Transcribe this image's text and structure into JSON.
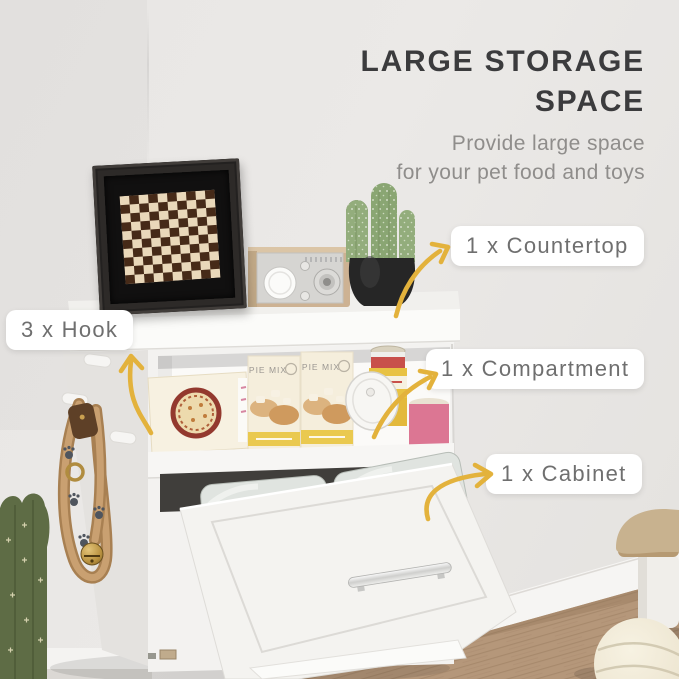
{
  "header": {
    "title": "LARGE STORAGE SPACE",
    "subtitle_line1": "Provide large space",
    "subtitle_line2": "for your pet food and toys"
  },
  "callouts": {
    "hook": "3 x Hook",
    "countertop": "1 x Countertop",
    "compartment": "1 x Compartment",
    "cabinet": "1 x Cabinet"
  },
  "scene": {
    "pie_box_label": "PIE MIX",
    "bag_script_word": "love",
    "bag_brand_word": "ples"
  },
  "colors": {
    "accent_arrow": "#E3B23C",
    "title_text": "#3B3B3D",
    "subtitle_text": "#8F8D8B",
    "label_text": "#6F6F6F",
    "label_bg": "#FFFFFF",
    "wall": "#E8E6E4",
    "cabinet_white": "#F3F2F0",
    "dark_gap": "#403E3B",
    "floor_wood": "#B5977A",
    "cactus_green": "#5E6C45",
    "collar_tan": "#C9A071",
    "pot_black": "#262626"
  }
}
